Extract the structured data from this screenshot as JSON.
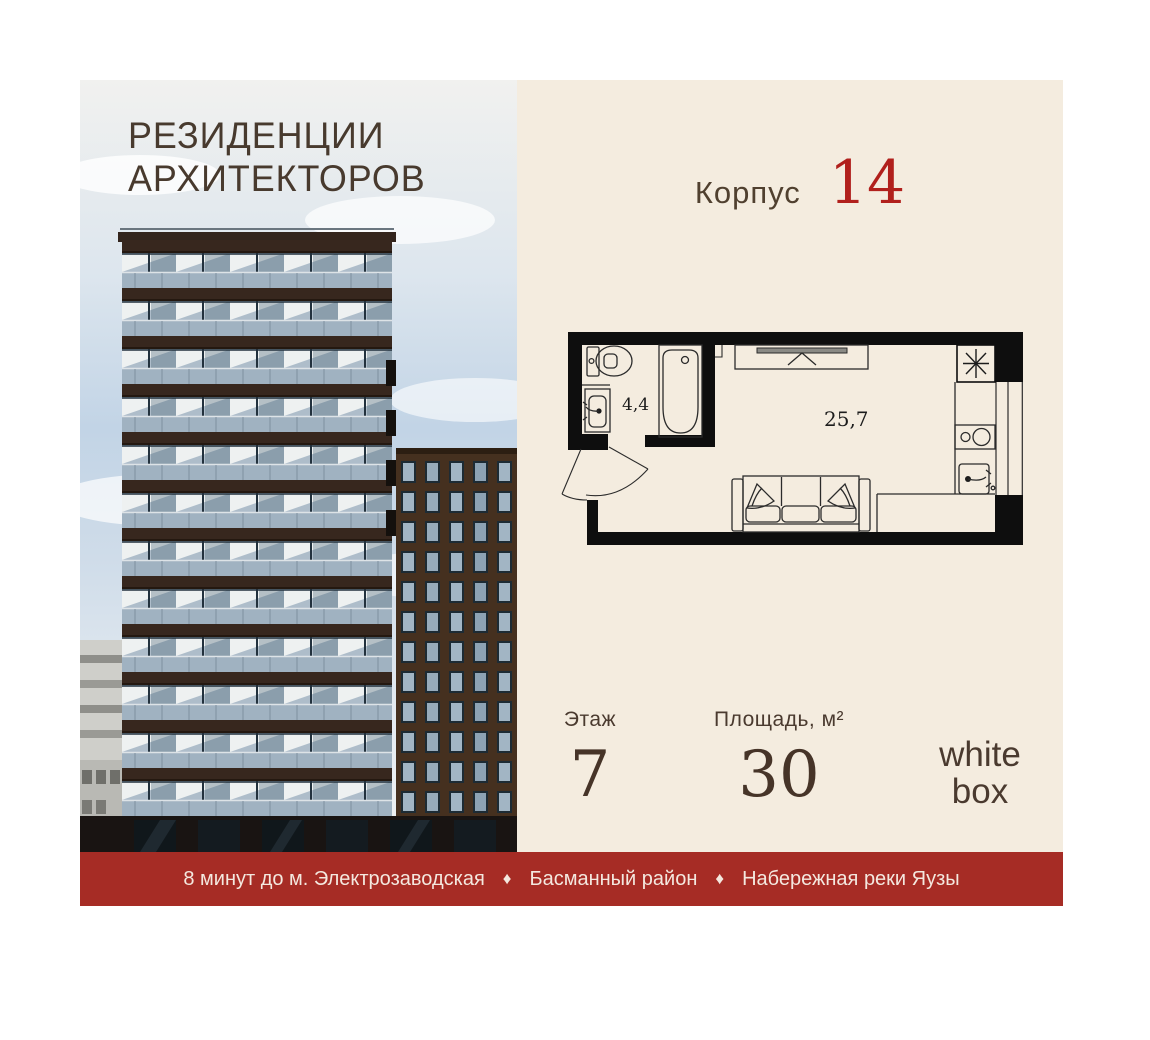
{
  "logo": {
    "line1": "РЕЗИДЕНЦИИ",
    "line2": "АРХИТЕКТОРОВ"
  },
  "header": {
    "korpus_label": "Корпус",
    "korpus_number": "14"
  },
  "floor_plan": {
    "bathroom_area": "4,4",
    "living_area": "25,7",
    "icons": [
      "toilet-icon",
      "bath-icon",
      "sink-icon",
      "wardrobe-icon",
      "sofa-icon",
      "vent-shaft-icon",
      "stove-icon",
      "kitchen-sink-icon",
      "door-swing-arc"
    ]
  },
  "stats": {
    "floor_label": "Этаж",
    "floor_value": "7",
    "area_label": "Площадь, м²",
    "area_value": "30",
    "finish_line1": "white",
    "finish_line2": "box"
  },
  "banner": {
    "items": [
      "8 минут до м. Электрозаводская",
      "Басманный район",
      "Набережная реки Яузы"
    ],
    "separator": "♦"
  },
  "colors": {
    "accent_red": "#b1201c",
    "banner_red": "#a62c25",
    "text_brown": "#4a3a2f",
    "panel_cream": "#f4ecdf"
  }
}
